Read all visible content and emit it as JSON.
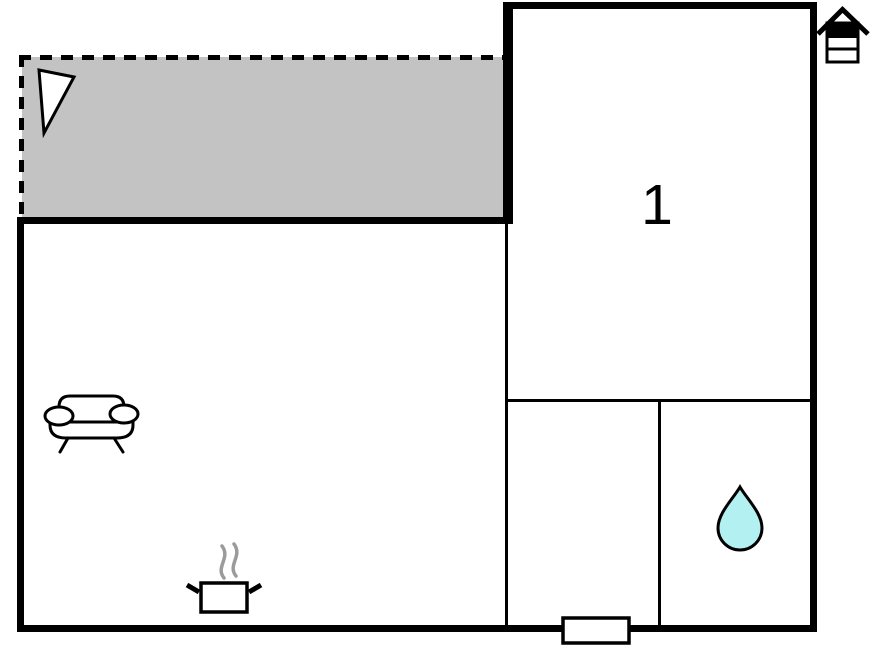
{
  "plan": {
    "room_label": "1",
    "icons": {
      "orientation_marker": "house-orientation-icon",
      "terrace_marker": "window-triangle-icon",
      "living_area": [
        "sofa-icon",
        "cooking-pot-icon",
        "steam-icon"
      ],
      "bathroom": "water-drop-icon",
      "entrance": "door-marker"
    }
  },
  "colors": {
    "background": "#ffffff",
    "wall": "#000000",
    "terrace_fill": "#c3c3c3",
    "water_drop_fill": "#b3f0f1",
    "steam": "#9b9b9b"
  }
}
